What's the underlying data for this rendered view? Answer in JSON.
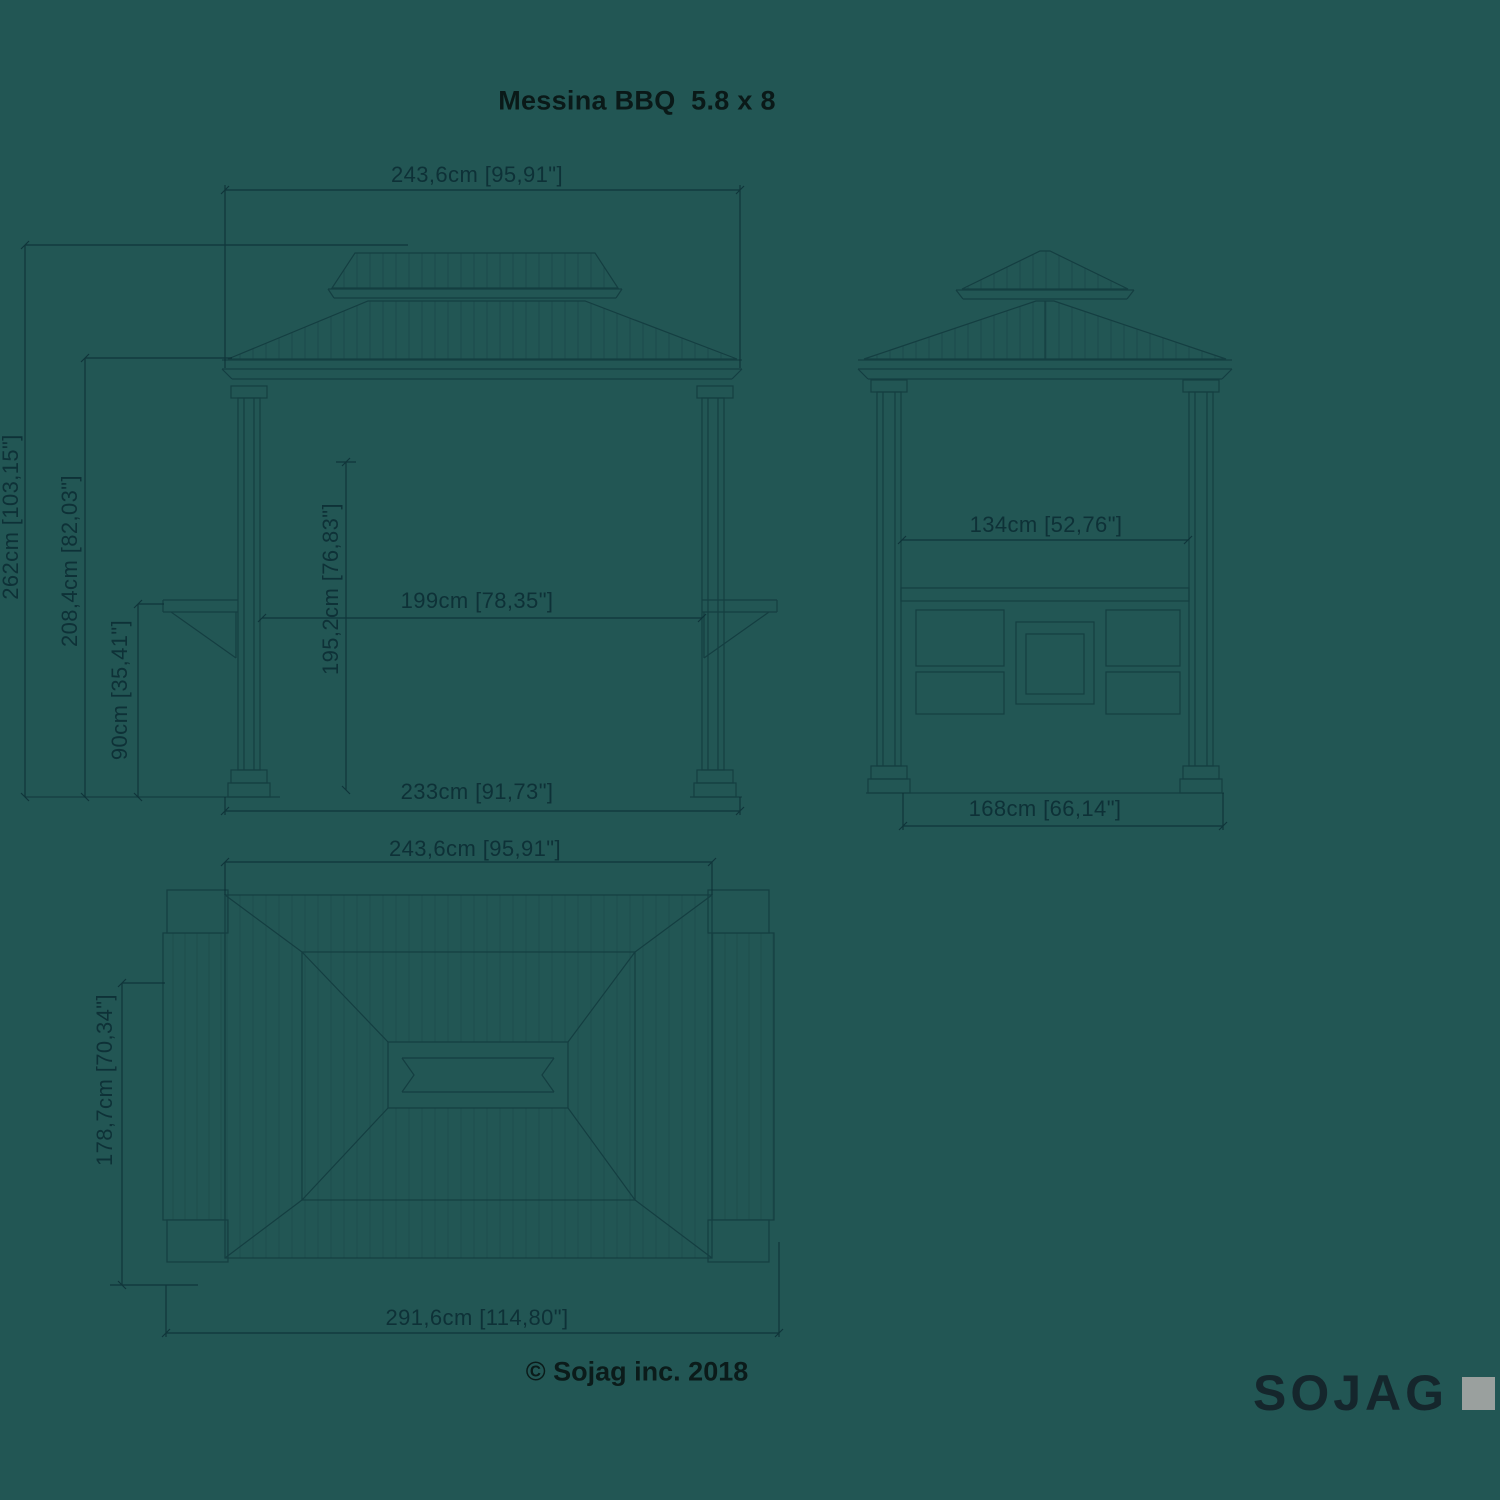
{
  "title": "Messina BBQ  5.8 x 8",
  "footer": {
    "copyright": "© Sojag inc. 2018",
    "brand": "SOJAG"
  },
  "colors": {
    "background": "#225654",
    "drawing_line": "#0d3036",
    "dimension_text": "#0e3137",
    "title_text": "#0a1918",
    "logo_text": "#15262c",
    "logo_square": "#9aa09e"
  },
  "views": {
    "front": {
      "name": "front elevation",
      "dimensions": [
        {
          "id": "roof-overall-width",
          "label": "243,6cm [95,91\"]"
        },
        {
          "id": "overall-height",
          "label": "262cm [103,15\"]"
        },
        {
          "id": "eave-height",
          "label": "208,4cm [82,03\"]"
        },
        {
          "id": "shelf-height",
          "label": "90cm [35,41\"]"
        },
        {
          "id": "clearance-height",
          "label": "195,2cm [76,83\"]"
        },
        {
          "id": "clear-width-between-posts",
          "label": "199cm [78,35\"]"
        },
        {
          "id": "base-width",
          "label": "233cm [91,73\"]"
        }
      ]
    },
    "side": {
      "name": "side elevation",
      "dimensions": [
        {
          "id": "clear-depth-between-posts",
          "label": "134cm [52,76\"]"
        },
        {
          "id": "base-depth",
          "label": "168cm [66,14\"]"
        }
      ]
    },
    "plan": {
      "name": "roof plan",
      "dimensions": [
        {
          "id": "roof-width",
          "label": "243,6cm [95,91\"]"
        },
        {
          "id": "roof-depth-with-shelves",
          "label": "178,7cm [70,34\"]"
        },
        {
          "id": "overall-width-with-shelves",
          "label": "291,6cm [114,80\"]"
        }
      ]
    }
  }
}
